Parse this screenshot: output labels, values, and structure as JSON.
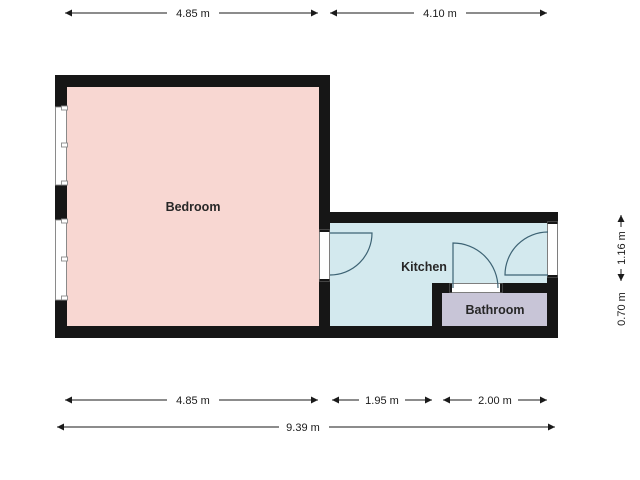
{
  "plan": {
    "rooms": [
      {
        "label": "Bedroom",
        "fill": "#f8d7d2"
      },
      {
        "label": "Kitchen",
        "fill": "#d3e9ee"
      },
      {
        "label": "Bathroom",
        "fill": "#c8c5d7"
      }
    ],
    "dimensions": {
      "top": [
        {
          "label": "4.85 m"
        },
        {
          "label": "4.10 m"
        }
      ],
      "bottom": [
        {
          "label": "4.85 m"
        },
        {
          "label": "1.95 m"
        },
        {
          "label": "2.00 m"
        }
      ],
      "bottom_total": {
        "label": "9.39 m"
      },
      "right": [
        {
          "label": "1.16 m"
        },
        {
          "label": "0.70 m"
        }
      ]
    },
    "colors": {
      "wall": "#161616",
      "dimension": "#1a1a1a",
      "door_swing": "#3d6374",
      "window_frame": "#8a8a8a",
      "bedroom_fill": "#f8d7d2",
      "kitchen_fill": "#d3e9ee",
      "bathroom_fill": "#c8c5d7"
    }
  }
}
